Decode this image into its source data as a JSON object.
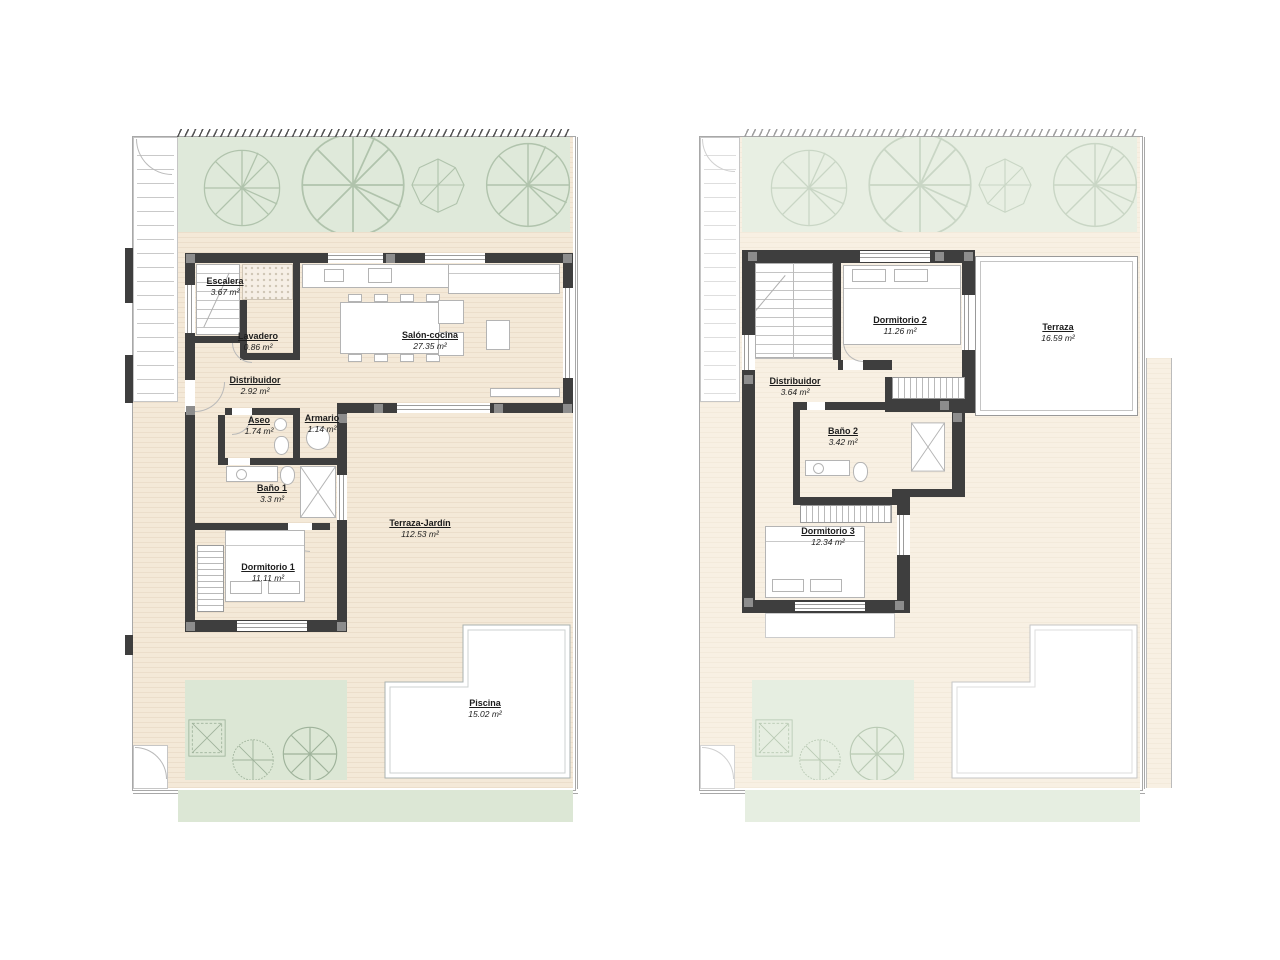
{
  "colors": {
    "wall": "#3e3e3e",
    "pillar": "#8d8d8d",
    "furniture": "#b4b4b4",
    "terrace": "#f4e9d8",
    "terrace-light": "#f8f0e3",
    "garden": "#dfe9da",
    "garden-light": "#e8efe3",
    "band-green": "#dce7d5",
    "band-green-light": "#e6eee1",
    "text": "#1c1c1c"
  },
  "ground": {
    "rooms": {
      "escalera": {
        "label": "Escalera",
        "area": "3.67 m²"
      },
      "lavadero": {
        "label": "Lavadero",
        "area": "0.86 m²"
      },
      "salon": {
        "label": "Salón-cocina",
        "area": "27.35 m²"
      },
      "distribuidor": {
        "label": "Distribuidor",
        "area": "2.92 m²"
      },
      "aseo": {
        "label": "Aseo",
        "area": "1.74 m²"
      },
      "armario": {
        "label": "Armario",
        "area": "1.14 m²"
      },
      "bano1": {
        "label": "Baño 1",
        "area": "3.3 m²"
      },
      "dormitorio1": {
        "label": "Dormitorio 1",
        "area": "11.11 m²"
      },
      "terraza_jardin": {
        "label": "Terraza-Jardín",
        "area": "112.53 m²"
      },
      "piscina": {
        "label": "Piscina",
        "area": "15.02 m²"
      }
    }
  },
  "first": {
    "rooms": {
      "dormitorio2": {
        "label": "Dormitorio 2",
        "area": "11.26 m²"
      },
      "terraza": {
        "label": "Terraza",
        "area": "16.59 m²"
      },
      "distribuidor": {
        "label": "Distribuidor",
        "area": "3.64 m²"
      },
      "bano2": {
        "label": "Baño 2",
        "area": "3.42 m²"
      },
      "dormitorio3": {
        "label": "Dormitorio 3",
        "area": "12.34 m²"
      }
    }
  }
}
